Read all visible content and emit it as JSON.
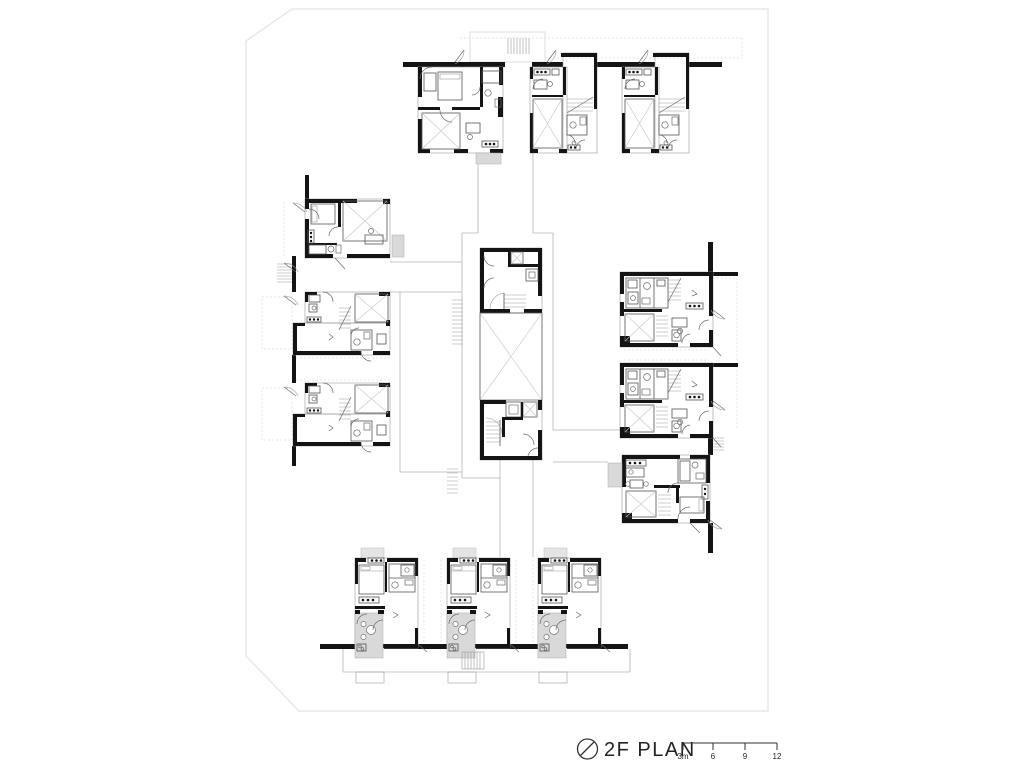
{
  "legend": {
    "icon": "north-indicator-icon",
    "title": "2F PLAN",
    "scale_labels": [
      "3m",
      "6",
      "9",
      "12"
    ]
  },
  "plan": {
    "kind": "architectural floor plan",
    "floor_label": "2F",
    "visible_unit_count": 12,
    "wings": [
      "north row of 3 units",
      "west stack of 3 units",
      "east stack of 3 units",
      "south row of 3 units"
    ],
    "core_elements": [
      "stair",
      "elevator",
      "void"
    ]
  },
  "colors": {
    "wall": "#141414",
    "furniture_line": "#6a6a6a",
    "light_line": "#9a9a9a",
    "terrace_fill": "#d9d9d9",
    "site_boundary": "#e3e3e3",
    "background": "#ffffff"
  }
}
